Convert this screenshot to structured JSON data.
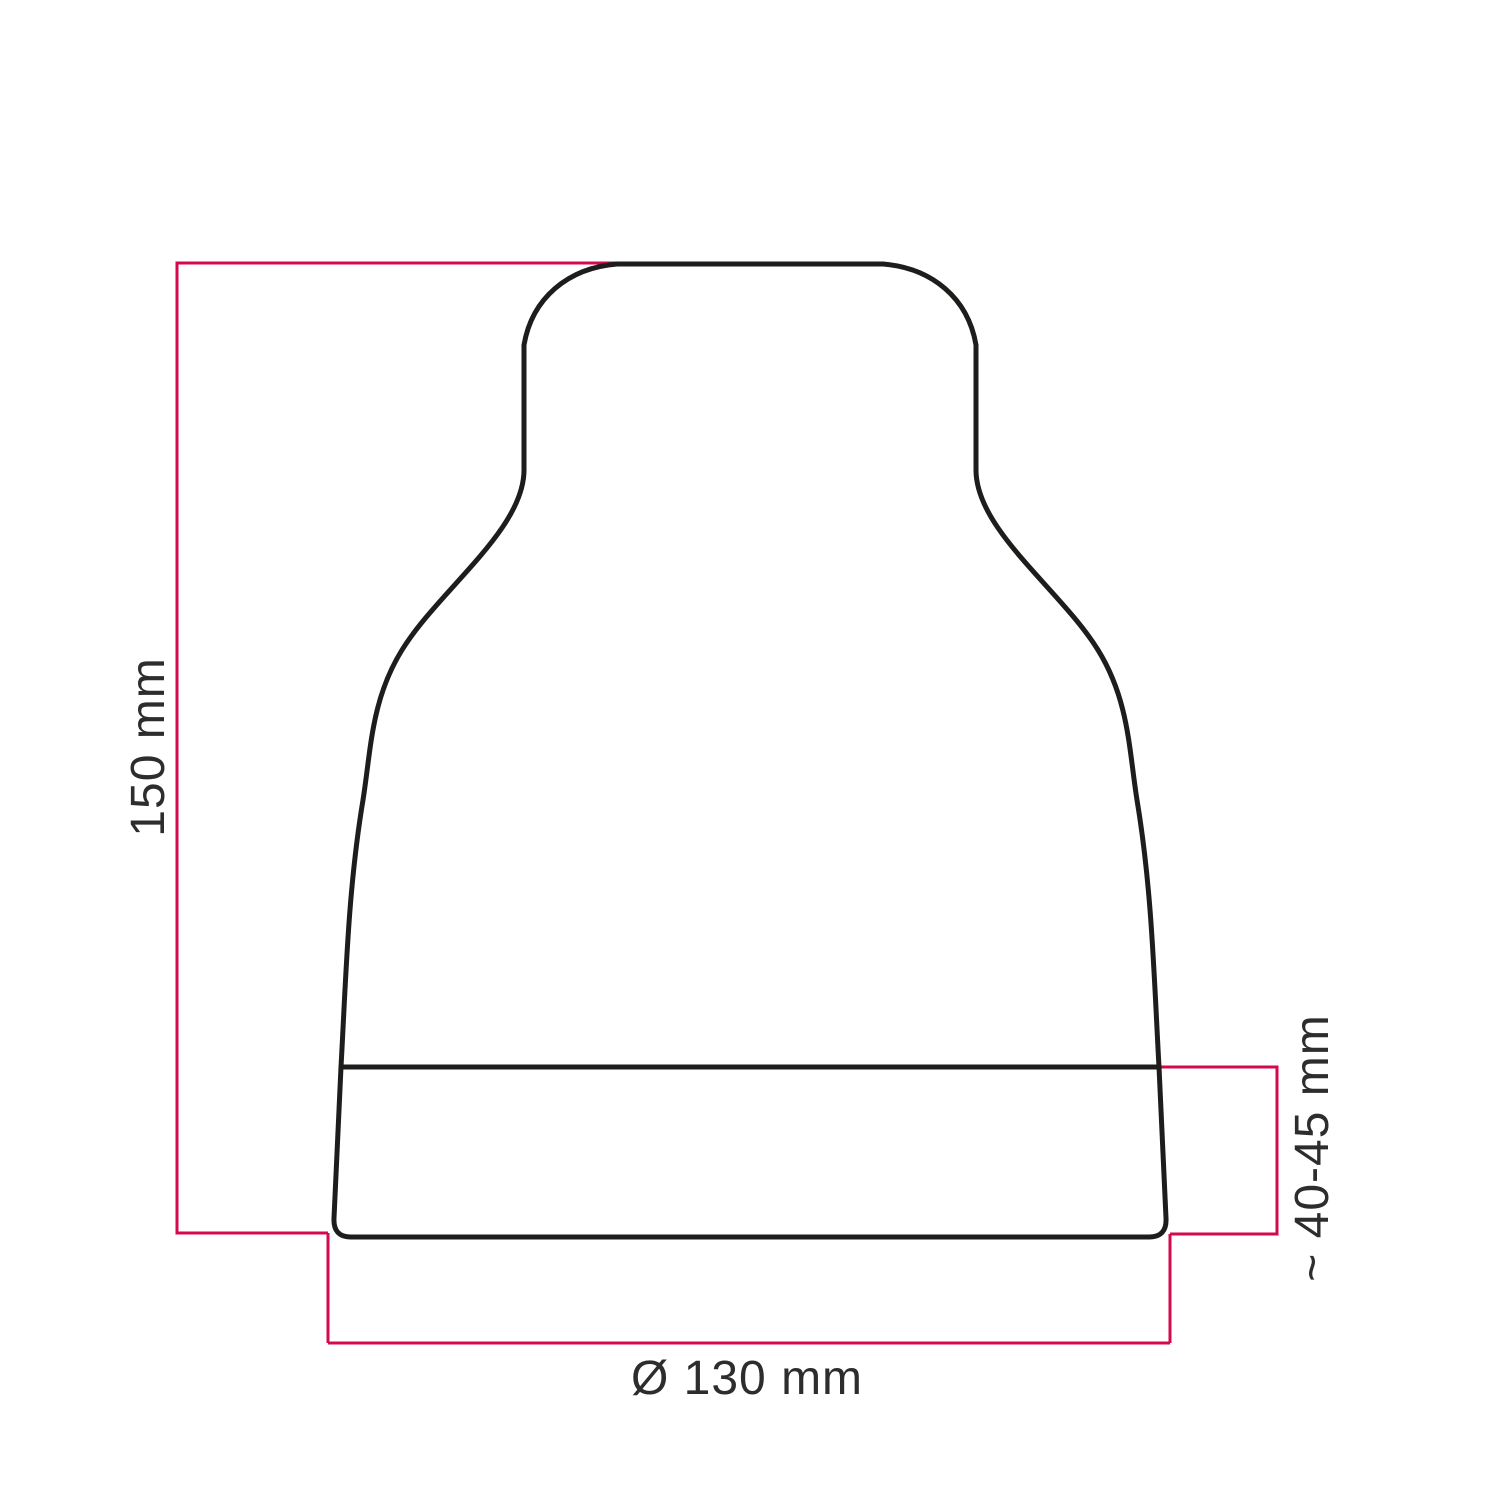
{
  "diagram": {
    "title": "Lampshade dimension drawing",
    "labels": {
      "height": "150 mm",
      "band_height": "~ 40-45 mm",
      "diameter": "Ø 130 mm"
    },
    "colors": {
      "outline": "#1d1d1b",
      "dimension": "#d5094e",
      "text": "#2d2d2d",
      "background": "#ffffff"
    }
  }
}
